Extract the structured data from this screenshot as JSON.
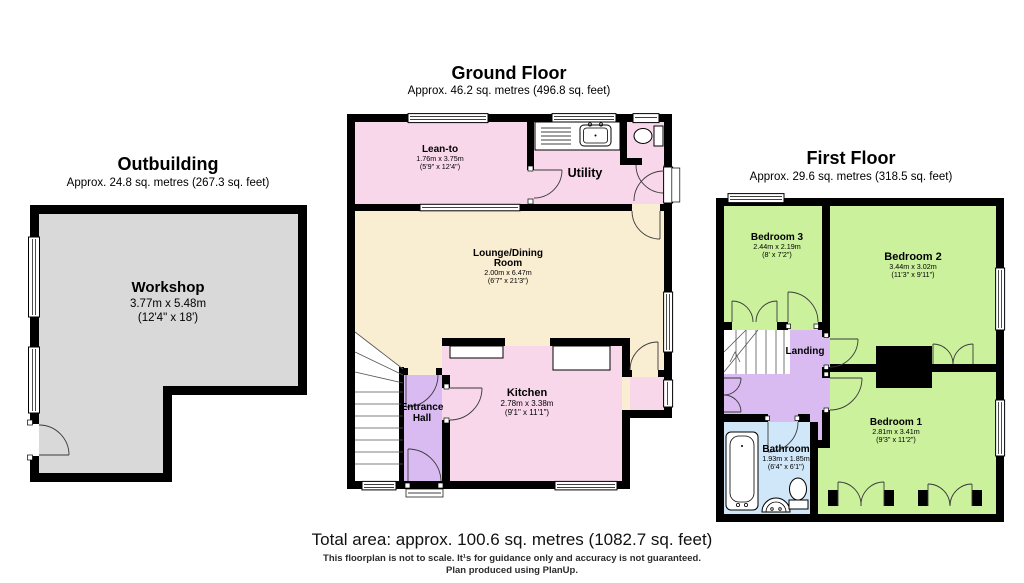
{
  "outbuilding": {
    "title": "Outbuilding",
    "subtitle": "Approx. 24.8 sq. metres (267.3 sq. feet)",
    "workshop": {
      "name": "Workshop",
      "metric": "3.77m x 5.48m",
      "imperial": "(12'4\" x 18')"
    }
  },
  "ground_floor": {
    "title": "Ground Floor",
    "subtitle": "Approx. 46.2 sq. metres (496.8 sq. feet)",
    "lean_to": {
      "name": "Lean-to",
      "metric": "1.76m x 3.75m",
      "imperial": "(5'9\" x 12'4\")"
    },
    "utility": {
      "name": "Utility"
    },
    "lounge": {
      "name1": "Lounge/Dining",
      "name2": "Room",
      "metric": "2.00m x 6.47m",
      "imperial": "(6'7\" x 21'3\")"
    },
    "entrance_hall": {
      "name1": "Entrance",
      "name2": "Hall"
    },
    "kitchen": {
      "name": "Kitchen",
      "metric": "2.78m x 3.38m",
      "imperial": "(9'1\" x 11'1\")"
    }
  },
  "first_floor": {
    "title": "First Floor",
    "subtitle": "Approx. 29.6 sq. metres (318.5 sq. feet)",
    "bedroom3": {
      "name": "Bedroom 3",
      "metric": "2.44m x 2.19m",
      "imperial": "(8' x 7'2\")"
    },
    "bedroom2": {
      "name": "Bedroom 2",
      "metric": "3.44m x 3.02m",
      "imperial": "(11'3\" x 9'11\")"
    },
    "landing": {
      "name": "Landing"
    },
    "bathroom": {
      "name": "Bathroom",
      "metric": "1.93m x 1.85m",
      "imperial": "(6'4\" x 6'1\")"
    },
    "bedroom1": {
      "name": "Bedroom 1",
      "metric": "2.81m x 3.41m",
      "imperial": "(9'3\" x 11'2\")"
    }
  },
  "footer": {
    "total_area": "Total area: approx. 100.6 sq. metres (1082.7 sq. feet)",
    "disclaimer": "This floorplan is not to scale. It¹s for guidance only and accuracy is not guaranteed.",
    "credit": "Plan produced using PlanUp."
  },
  "colors": {
    "wall": "#000000",
    "workshop_grey": "#d9d9d9",
    "room_pink": "#f8d7eb",
    "room_cream": "#f9edd2",
    "room_purple": "#d9bbf2",
    "room_green": "#cbf19c",
    "room_blue": "#cfe7f8"
  }
}
